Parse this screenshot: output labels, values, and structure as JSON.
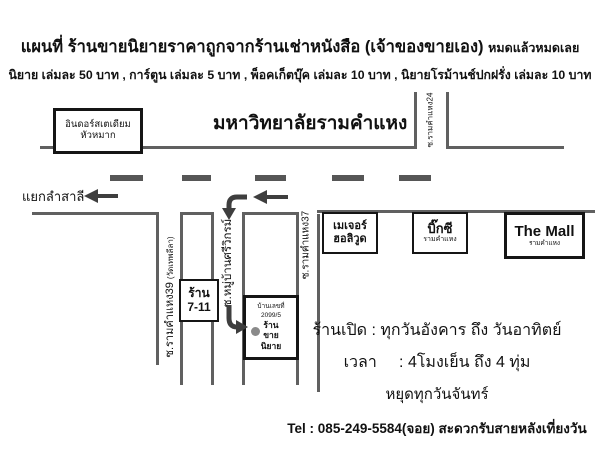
{
  "header": {
    "title": "แผนที่ ร้านขายนิยายราคาถูกจากร้านเช่าหนังสือ (เจ้าของขายเอง)",
    "title_suffix": "หมดแล้วหมดเลย",
    "subtitle": "นิยาย เล่มละ 50 บาท , การ์ตูน เล่มละ 5 บาท , พ็อคเก็ตบุ๊ค เล่มละ 10 บาท , นิยายโรม้านช์ปกฝรั่ง เล่มละ 10 บาท"
  },
  "map": {
    "university_label": "มหาวิทยาลัยรามคำแหง",
    "stadium": {
      "line1": "อินดอร์สเตเดียม",
      "line2": "หัวหมาก"
    },
    "intersection_label": "แยกลำสาลี",
    "roads": {
      "soi24": "ซ.รามคำแหง24",
      "soi39": "ซ.รามคำแหง39",
      "soi39_note": "(วัดเทพลีลา)",
      "soi_srivikrom": "ซ.หมู่บ้านศรีวิกรม์",
      "soi37": "ซ.รามคำแหง37"
    },
    "places": {
      "seven_eleven": {
        "line1": "ร้าน",
        "line2": "7-11"
      },
      "shop": {
        "line1": "บ้านเลขที่",
        "line2": "2099/5",
        "line3": "ร้าน",
        "line4": "ขาย",
        "line5": "นิยาย"
      },
      "major": {
        "line1": "เมเจอร์",
        "line2": "ฮอลิวูด"
      },
      "bigc": {
        "line1": "บิ๊กซี",
        "line2": "รามคำแหง"
      },
      "the_mall": {
        "line1": "The Mall",
        "line2": "รามคำแหง"
      }
    }
  },
  "info": {
    "open_days": "ร้านเปิด : ทุกวันอังคาร ถึง วันอาทิตย์",
    "open_hours": "เวลา     : 4โมงเย็น ถึง 4 ทุ่ม",
    "closed": "หยุดทุกวันจันทร์",
    "tel": "Tel : 085-249-5584(จอย) สะดวกรับสายหลังเที่ยงวัน"
  },
  "colors": {
    "road": "#606060",
    "box_border": "#151515",
    "text": "#111111",
    "dot": "#8a8a8a"
  }
}
